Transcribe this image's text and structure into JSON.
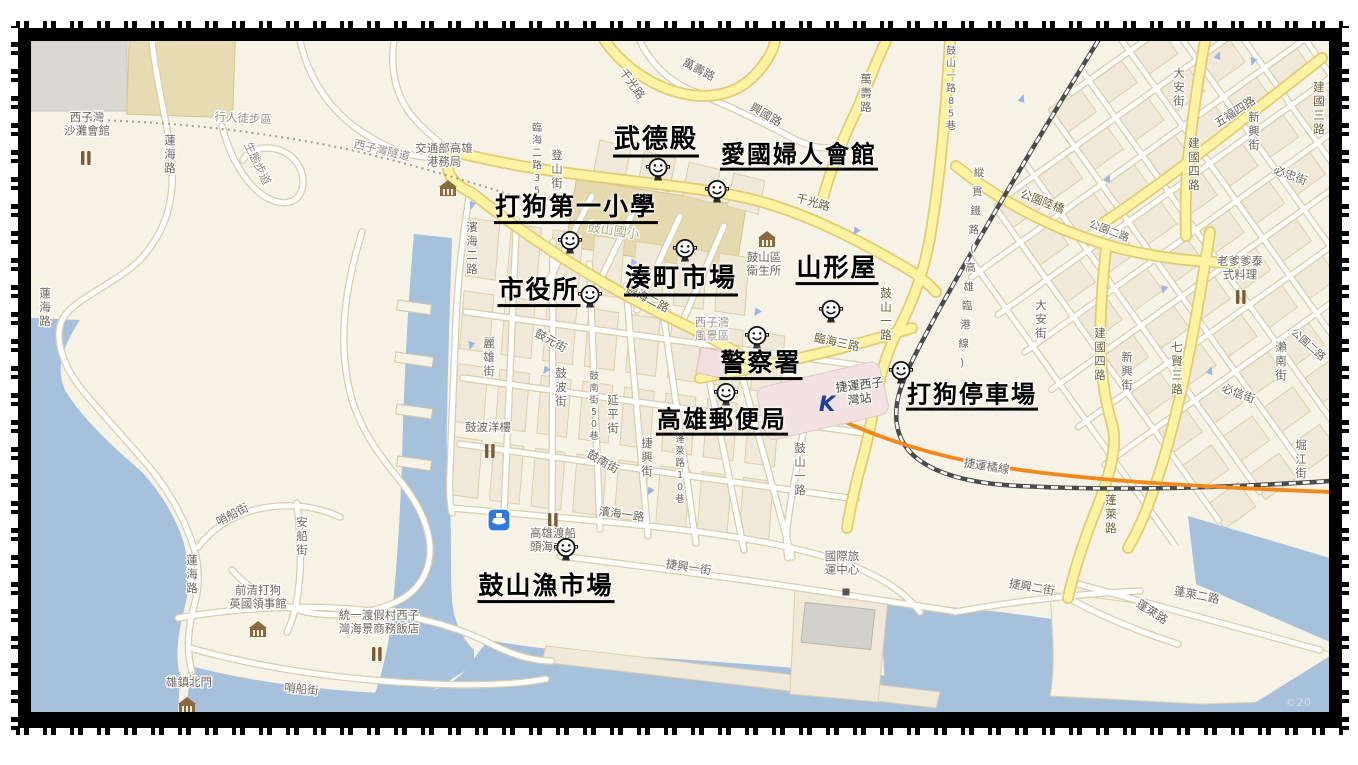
{
  "page": {
    "copyright": "©20"
  },
  "colors": {
    "land": "#f6f2e6",
    "water": "#a7c0dc",
    "block_fill": "#f0e9d9",
    "block_stroke": "#dccfa9",
    "road_casing": "#d9cdab",
    "road_fill": "#ffffff",
    "yellow_casing": "#e2cc73",
    "yellow_fill": "#fdf3a3",
    "railway": "#4a4a4a",
    "mrt_orange": "#f0891d",
    "label_normal": "#6d675b",
    "label_on_yellow": "#6b5d31",
    "label_path": "#948d80",
    "label_faint": "#b3a67c",
    "station_pink": "#f2e2e2",
    "mrt_logo_blue": "#1c3f9e",
    "ferry_blue": "#3079d8",
    "poi_brown": "#7a5c33"
  },
  "map": {
    "annotations": [
      {
        "t": "武德殿",
        "x": 656,
        "y": 143,
        "s": 26
      },
      {
        "t": "愛國婦人會館",
        "x": 799,
        "y": 158,
        "s": 24
      },
      {
        "t": "打狗第一小學",
        "x": 576,
        "y": 210,
        "s": 25
      },
      {
        "t": "湊町市場",
        "x": 681,
        "y": 282,
        "s": 26
      },
      {
        "t": "山形屋",
        "x": 837,
        "y": 271,
        "s": 25
      },
      {
        "t": "市役所",
        "x": 539,
        "y": 293,
        "s": 25
      },
      {
        "t": "警察署",
        "x": 761,
        "y": 366,
        "s": 25
      },
      {
        "t": "高雄郵便局",
        "x": 722,
        "y": 423,
        "s": 24
      },
      {
        "t": "打狗停車場",
        "x": 972,
        "y": 398,
        "s": 24
      },
      {
        "t": "鼓山漁市場",
        "x": 546,
        "y": 589,
        "s": 25
      }
    ],
    "markers": [
      {
        "x": 658,
        "y": 169
      },
      {
        "x": 717,
        "y": 191
      },
      {
        "x": 570,
        "y": 242
      },
      {
        "x": 685,
        "y": 250
      },
      {
        "x": 590,
        "y": 296
      },
      {
        "x": 831,
        "y": 311
      },
      {
        "x": 757,
        "y": 337
      },
      {
        "x": 726,
        "y": 394
      },
      {
        "x": 901,
        "y": 372
      },
      {
        "x": 566,
        "y": 549
      }
    ],
    "street_labels": [
      {
        "t": "萬壽路",
        "x": 697,
        "y": 73,
        "r": 27
      },
      {
        "t": "萬壽路",
        "x": 866,
        "y": 83,
        "v": true
      },
      {
        "t": "千光路",
        "x": 629,
        "y": 86,
        "r": 55
      },
      {
        "t": "興國路",
        "x": 764,
        "y": 118,
        "r": 30
      },
      {
        "t": "千光路",
        "x": 812,
        "y": 206,
        "r": 16,
        "c": "y"
      },
      {
        "t": "臨海二路35巷",
        "x": 537,
        "y": 131,
        "v": true,
        "s": 10
      },
      {
        "t": "登山街",
        "x": 557,
        "y": 159,
        "v": true
      },
      {
        "t": "濱海二路",
        "x": 472,
        "y": 231,
        "v": true
      },
      {
        "t": "臨海二路",
        "x": 646,
        "y": 302,
        "r": 27,
        "c": "y"
      },
      {
        "t": "臨海三路",
        "x": 836,
        "y": 346,
        "r": 12,
        "c": "y"
      },
      {
        "t": "鼓山一路85巷",
        "x": 951,
        "y": 54,
        "v": true,
        "s": 10
      },
      {
        "t": "鼓山一路",
        "x": 886,
        "y": 297,
        "v": true,
        "c": "y"
      },
      {
        "t": "鼓山一路",
        "x": 800,
        "y": 452,
        "v": true
      },
      {
        "t": "公園陸橋",
        "x": 1041,
        "y": 205,
        "r": 21,
        "c": "y"
      },
      {
        "t": "公園二路",
        "x": 1108,
        "y": 234,
        "r": 21,
        "s": 10.5
      },
      {
        "t": "公園二路",
        "x": 1306,
        "y": 347,
        "r": 42,
        "s": 10.5
      },
      {
        "t": "五福四路",
        "x": 1237,
        "y": 115,
        "r": -33
      },
      {
        "t": "建國四路",
        "x": 1194,
        "y": 147,
        "v": true,
        "c": "y"
      },
      {
        "t": "建國四路",
        "x": 1100,
        "y": 337,
        "v": true,
        "c": "y"
      },
      {
        "t": "大安街",
        "x": 1179,
        "y": 77,
        "v": true
      },
      {
        "t": "大安街",
        "x": 1041,
        "y": 309,
        "v": true
      },
      {
        "t": "新興街",
        "x": 1254,
        "y": 121,
        "v": true
      },
      {
        "t": "新興街",
        "x": 1127,
        "y": 361,
        "v": true
      },
      {
        "t": "必忠街",
        "x": 1289,
        "y": 179,
        "r": 20
      },
      {
        "t": "必信街",
        "x": 1237,
        "y": 397,
        "r": 21
      },
      {
        "t": "七賢三路",
        "x": 1177,
        "y": 351,
        "v": true,
        "c": "y"
      },
      {
        "t": "建國三路",
        "x": 1319,
        "y": 91,
        "v": true,
        "c": "y"
      },
      {
        "t": "瀨南街",
        "x": 1281,
        "y": 351,
        "v": true
      },
      {
        "t": "堀江街",
        "x": 1301,
        "y": 449,
        "v": true
      },
      {
        "t": "縱貫鐵路(高雄臨港線)",
        "x": 979,
        "y": 176,
        "v": true,
        "dh": 19,
        "dx": -1.7,
        "s": 10.5
      },
      {
        "t": "捷運橘線",
        "x": 986,
        "y": 470,
        "r": 9
      },
      {
        "t": "蓬萊路",
        "x": 1111,
        "y": 504,
        "v": true,
        "c": "y"
      },
      {
        "t": "蓬萊路",
        "x": 1150,
        "y": 615,
        "r": 33
      },
      {
        "t": "蓬萊二路",
        "x": 1196,
        "y": 599,
        "r": 11
      },
      {
        "t": "捷興二街",
        "x": 1031,
        "y": 591,
        "r": 10
      },
      {
        "t": "捷興一街",
        "x": 688,
        "y": 571,
        "r": 9
      },
      {
        "t": "濱海一路",
        "x": 621,
        "y": 518,
        "r": 8
      },
      {
        "t": "蓮海路",
        "x": 170,
        "y": 144,
        "v": true
      },
      {
        "t": "蓮海路",
        "x": 45,
        "y": 297,
        "v": true
      },
      {
        "t": "蓮海路",
        "x": 192,
        "y": 564,
        "v": true
      },
      {
        "t": "行人徒步區",
        "x": 243,
        "y": 122,
        "r": 3,
        "c": "p"
      },
      {
        "t": "西子灣隧道",
        "x": 381,
        "y": 154,
        "r": 13,
        "c": "p"
      },
      {
        "t": "生態步道",
        "x": 254,
        "y": 165,
        "r": 64,
        "c": "p"
      },
      {
        "t": "哨船街",
        "x": 234,
        "y": 518,
        "r": -27
      },
      {
        "t": "安船街",
        "x": 302,
        "y": 526,
        "v": true
      },
      {
        "t": "哨船街",
        "x": 301,
        "y": 693,
        "r": 6
      },
      {
        "t": "鼓元街",
        "x": 549,
        "y": 344,
        "r": 29
      },
      {
        "t": "麗雄街",
        "x": 489,
        "y": 347,
        "v": true
      },
      {
        "t": "鼓波街",
        "x": 561,
        "y": 377,
        "v": true
      },
      {
        "t": "鼓南街50巷",
        "x": 594,
        "y": 379,
        "v": true,
        "s": 9.5
      },
      {
        "t": "延平街",
        "x": 613,
        "y": 404,
        "v": true
      },
      {
        "t": "鼓南街",
        "x": 601,
        "y": 465,
        "r": 30
      },
      {
        "t": "捷興街",
        "x": 647,
        "y": 447,
        "v": true
      },
      {
        "t": "蓬萊路10巷",
        "x": 680,
        "y": 442,
        "v": true,
        "s": 9.5
      },
      {
        "t": "鼓山國小",
        "x": 613,
        "y": 235,
        "r": 9,
        "c": "f",
        "s": 13
      }
    ],
    "poi_labels": [
      {
        "l": [
          "西子灣",
          "沙灘會館"
        ],
        "x": 87,
        "y": 121
      },
      {
        "l": [
          "交通部高雄",
          "港務局"
        ],
        "x": 444,
        "y": 152
      },
      {
        "l": [
          "鼓山區",
          "衛生所"
        ],
        "x": 764,
        "y": 261
      },
      {
        "l": [
          "西子灣",
          "風景區"
        ],
        "x": 712,
        "y": 326,
        "c": "#a38f8f"
      },
      {
        "l": [
          "捷運西子",
          "灣站"
        ],
        "x": 860,
        "y": 389,
        "r": -7,
        "c": "#45453e",
        "s": 12
      },
      {
        "l": [
          "老爹爹泰",
          "式料理"
        ],
        "x": 1240,
        "y": 265
      },
      {
        "l": [
          "鼓波洋樓"
        ],
        "x": 488,
        "y": 431
      },
      {
        "l": [
          "高雄渡船",
          "頭海之冰"
        ],
        "x": 553,
        "y": 537
      },
      {
        "l": [
          "國際旅",
          "運中心"
        ],
        "x": 842,
        "y": 560
      },
      {
        "l": [
          "前清打狗",
          "英國領事館"
        ],
        "x": 258,
        "y": 594
      },
      {
        "l": [
          "統一渡假村西子",
          "灣海景商務飯店"
        ],
        "x": 379,
        "y": 619
      },
      {
        "l": [
          "雄鎮北門"
        ],
        "x": 189,
        "y": 686
      }
    ],
    "icons": [
      {
        "type": "restaurant-icon",
        "x": 86,
        "y": 158
      },
      {
        "type": "restaurant-icon",
        "x": 490,
        "y": 451
      },
      {
        "type": "restaurant-icon",
        "x": 553,
        "y": 520
      },
      {
        "type": "restaurant-icon",
        "x": 377,
        "y": 654
      },
      {
        "type": "restaurant-icon",
        "x": 1241,
        "y": 297
      },
      {
        "type": "government-building-icon",
        "x": 448,
        "y": 189
      },
      {
        "type": "government-building-icon",
        "x": 767,
        "y": 240
      },
      {
        "type": "government-building-icon",
        "x": 258,
        "y": 630
      },
      {
        "type": "government-building-icon",
        "x": 187,
        "y": 706
      },
      {
        "type": "ferry-icon",
        "x": 499,
        "y": 520
      },
      {
        "type": "mrt-k-logo",
        "x": 827,
        "y": 404
      },
      {
        "type": "poi-square-icon",
        "x": 846,
        "y": 592
      }
    ],
    "arrows": [
      [
        472,
        205,
        15
      ],
      [
        471,
        345,
        15
      ],
      [
        546,
        370,
        35
      ],
      [
        633,
        263,
        35
      ],
      [
        757,
        312,
        35
      ],
      [
        856,
        231,
        35
      ],
      [
        650,
        491,
        30
      ],
      [
        1218,
        56,
        200
      ],
      [
        1022,
        99,
        200
      ],
      [
        1108,
        179,
        200
      ],
      [
        1164,
        289,
        15
      ],
      [
        1210,
        371,
        200
      ],
      [
        1253,
        61,
        20
      ]
    ]
  }
}
